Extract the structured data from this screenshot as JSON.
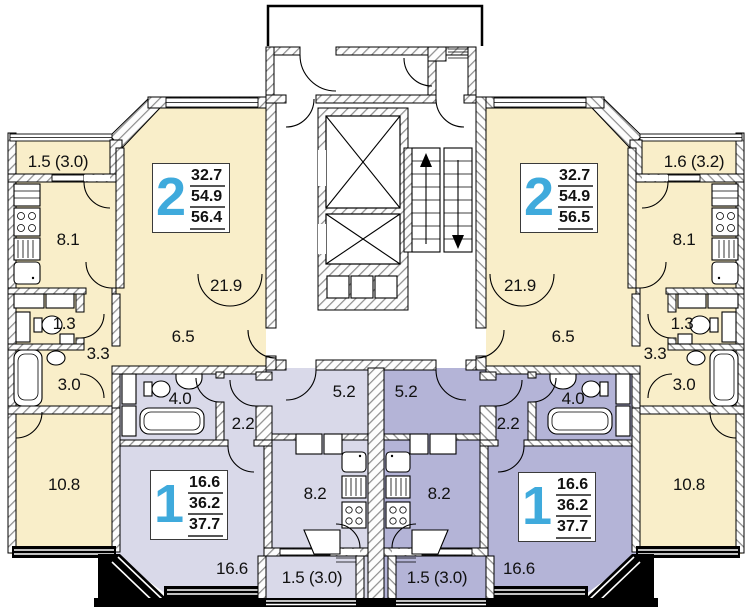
{
  "plan": {
    "title": "apartment-floor-plan",
    "colors": {
      "apartment2": "#F9EEC9",
      "apartment1_left": "#D9D9E9",
      "apartment1_right": "#B4B4D7",
      "badge_number": "#3FAADC"
    },
    "badges": [
      {
        "name": "apt-2-left-badge",
        "number": "2",
        "areas": [
          "32.7",
          "54.9",
          "56.4"
        ],
        "x": 152,
        "y": 163
      },
      {
        "name": "apt-2-right-badge",
        "number": "2",
        "areas": [
          "32.7",
          "54.9",
          "56.5"
        ],
        "x": 520,
        "y": 163
      },
      {
        "name": "apt-1-left-badge",
        "number": "1",
        "areas": [
          "16.6",
          "36.2",
          "37.7"
        ],
        "x": 150,
        "y": 470
      },
      {
        "name": "apt-1-right-badge",
        "number": "1",
        "areas": [
          "16.6",
          "36.2",
          "37.7"
        ],
        "x": 518,
        "y": 472
      }
    ],
    "labels": [
      {
        "name": "balcony-top-left",
        "text": "1.5 (3.0)",
        "x": 58,
        "y": 162
      },
      {
        "name": "kitchen-left",
        "text": "8.1",
        "x": 68,
        "y": 240
      },
      {
        "name": "living-left",
        "text": "21.9",
        "x": 226,
        "y": 286
      },
      {
        "name": "hall-left",
        "text": "6.5",
        "x": 183,
        "y": 337
      },
      {
        "name": "wc-left",
        "text": "1.3",
        "x": 64,
        "y": 324
      },
      {
        "name": "corridor-left",
        "text": "3.3",
        "x": 98,
        "y": 354
      },
      {
        "name": "bath-left",
        "text": "3.0",
        "x": 69,
        "y": 385
      },
      {
        "name": "bedroom-left",
        "text": "10.8",
        "x": 64,
        "y": 485
      },
      {
        "name": "bath-apt1-left",
        "text": "4.0",
        "x": 180,
        "y": 399
      },
      {
        "name": "corridor-apt1-left",
        "text": "2.2",
        "x": 243,
        "y": 424
      },
      {
        "name": "hall-apt1-left",
        "text": "5.2",
        "x": 344,
        "y": 392
      },
      {
        "name": "kitchen-apt1-left",
        "text": "8.2",
        "x": 315,
        "y": 494
      },
      {
        "name": "living-apt1-left",
        "text": "16.6",
        "x": 232,
        "y": 569
      },
      {
        "name": "balcony-apt1-left",
        "text": "1.5 (3.0)",
        "x": 312,
        "y": 578
      },
      {
        "name": "balcony-top-right",
        "text": "1.6 (3.2)",
        "x": 694,
        "y": 162
      },
      {
        "name": "kitchen-right",
        "text": "8.1",
        "x": 684,
        "y": 240
      },
      {
        "name": "living-right",
        "text": "21.9",
        "x": 520,
        "y": 286
      },
      {
        "name": "hall-right",
        "text": "6.5",
        "x": 563,
        "y": 337
      },
      {
        "name": "wc-right",
        "text": "1.3",
        "x": 682,
        "y": 324
      },
      {
        "name": "corridor-right",
        "text": "3.3",
        "x": 655,
        "y": 354
      },
      {
        "name": "bath-right",
        "text": "3.0",
        "x": 684,
        "y": 385
      },
      {
        "name": "bedroom-right",
        "text": "10.8",
        "x": 689,
        "y": 485
      },
      {
        "name": "bath-apt1-right",
        "text": "4.0",
        "x": 573,
        "y": 399
      },
      {
        "name": "corridor-apt1-right",
        "text": "2.2",
        "x": 508,
        "y": 424
      },
      {
        "name": "hall-apt1-right",
        "text": "5.2",
        "x": 406,
        "y": 392
      },
      {
        "name": "kitchen-apt1-right",
        "text": "8.2",
        "x": 439,
        "y": 494
      },
      {
        "name": "living-apt1-right",
        "text": "16.6",
        "x": 519,
        "y": 569
      },
      {
        "name": "balcony-apt1-right",
        "text": "1.5 (3.0)",
        "x": 437,
        "y": 578
      }
    ]
  }
}
